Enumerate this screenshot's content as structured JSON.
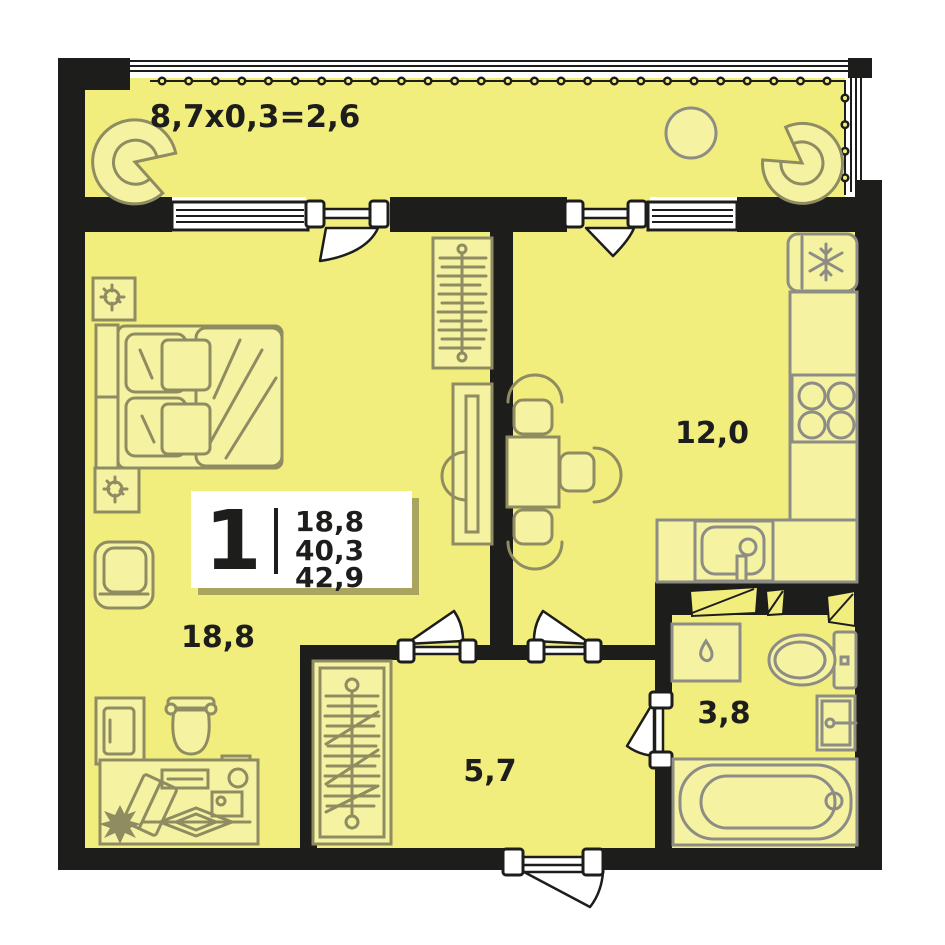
{
  "plan": {
    "balcony_label": "8,7x0,3=2,6",
    "rooms": {
      "living": "18,8",
      "kitchen": "12,0",
      "hallway": "5,7",
      "bathroom": "3,8"
    },
    "stats": {
      "rooms_count": "1",
      "living_area": "18,8",
      "area": "40,3",
      "total_area": "42,9"
    },
    "colors": {
      "floor": "#f2ee7d",
      "wall": "#1d1d1b",
      "furniture_stroke": "#8f8c62",
      "fixture_stroke": "#8d8d85",
      "stats_box": "#ffffff"
    }
  }
}
